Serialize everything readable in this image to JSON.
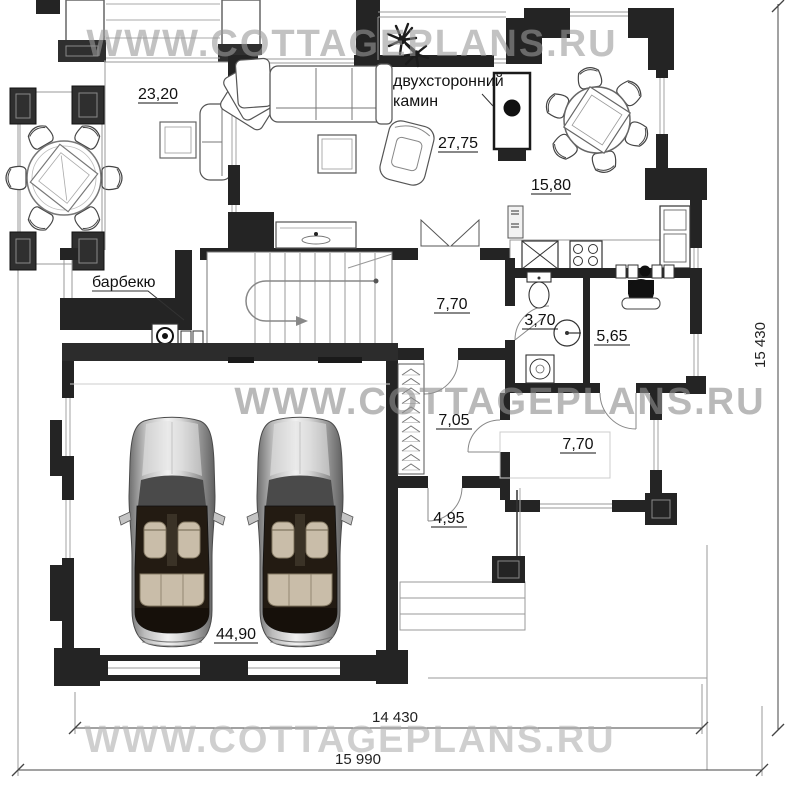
{
  "watermarks": {
    "top": "WWW.COTTAGEPLANS.RU",
    "middle": "WWW.COTTAGEPLANS.RU",
    "bottom": "WWW.COTTAGEPLANS.RU"
  },
  "annotations": {
    "fireplace_label_line1": "двухсторонний",
    "fireplace_label_line2": "камин",
    "barbecue_label": "барбекю"
  },
  "room_areas": {
    "terrace": "23,20",
    "living_room": "27,75",
    "kitchen_dining": "15,80",
    "hall": "7,70",
    "bathroom": "3,70",
    "boiler_room": "5,65",
    "wardrobe_hall": "7,05",
    "entry_hall": "7,70",
    "porch": "4,95",
    "garage": "44,90"
  },
  "dimensions": {
    "right_vertical": "15 430",
    "bottom_inner": "14 430",
    "bottom_outer": "15 990"
  },
  "colors": {
    "wall": "#242424",
    "wall_dark_gray": "#3c3c3c",
    "thin_line": "#999999",
    "watermark_gray": "#9a9a9a",
    "label_text": "#111111"
  }
}
